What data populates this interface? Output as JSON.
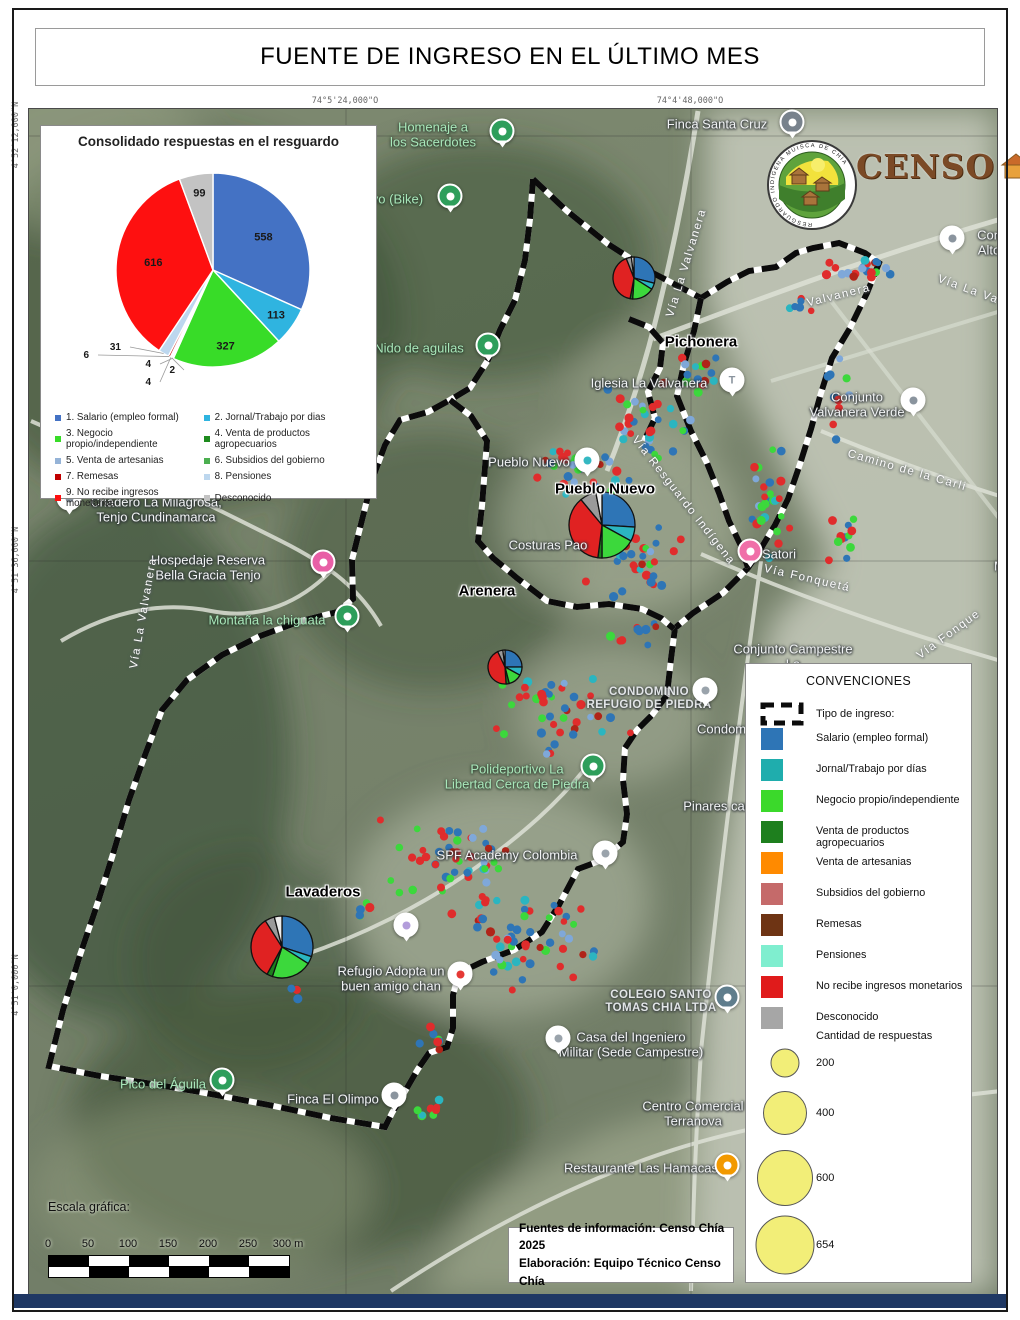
{
  "title": "FUENTE DE INGRESO EN EL ÚLTIMO MES",
  "coordinates": {
    "top": [
      "74°5'24,000\"O",
      "74°4'48,000\"O"
    ],
    "left": [
      "4°52'12,000\"N",
      "4°51'36,000\"N",
      "4°51'0,000\"N"
    ]
  },
  "chart_data": {
    "type": "pie",
    "title": "Consolidado respuestas en el resguardo",
    "labels": [
      "1. Salario (empleo formal)",
      "2. Jornal/Trabajo por dias",
      "3. Negocio propio/independiente",
      "4. Venta de productos agropecuarios",
      "5. Venta de artesanias",
      "6. Subsidios del gobierno",
      "7. Remesas",
      "8. Pensiones",
      "9. No recibe ingresos monetarios",
      "Desconocido"
    ],
    "values": [
      558,
      113,
      327,
      4,
      2,
      4,
      6,
      31,
      616,
      99
    ],
    "colors": [
      "#4472C4",
      "#2FB4E0",
      "#38DC28",
      "#1E8B1E",
      "#95B3D7",
      "#4CAF50",
      "#C00000",
      "#BDD7EE",
      "#FE1010",
      "#C3C3C3"
    ],
    "total": 1760,
    "legend_position": "bottom"
  },
  "legend_right": {
    "title": "CONVENCIONES",
    "boundary_label": "Tipo de ingreso:",
    "items": [
      {
        "label": "Salario (empleo formal)",
        "color": "#2E75B6"
      },
      {
        "label": "Jornal/Trabajo por días",
        "color": "#1FADAD"
      },
      {
        "label": "Negocio propio/independiente",
        "color": "#3BD92B"
      },
      {
        "label": "Venta de productos agropecuarios",
        "color": "#1E7F1E"
      },
      {
        "label": "Venta de artesanias",
        "color": "#FF8A00"
      },
      {
        "label": "Subsidios del gobierno",
        "color": "#C56A6A"
      },
      {
        "label": "Remesas",
        "color": "#6E3414"
      },
      {
        "label": "Pensiones",
        "color": "#7FEECF"
      },
      {
        "label": "No recibe ingresos monetarios",
        "color": "#E01B1B"
      },
      {
        "label": "Desconocido",
        "color": "#A6A6A6"
      }
    ],
    "sizes_title": "Cantidad de respuestas",
    "circle_color": "#F2EE78",
    "sizes": [
      {
        "value": "200",
        "d": 27
      },
      {
        "value": "400",
        "d": 42
      },
      {
        "value": "600",
        "d": 54
      },
      {
        "value": "654",
        "d": 57
      }
    ]
  },
  "scale": {
    "label": "Escala gráfica:",
    "ticks": [
      "0",
      "50",
      "100",
      "150",
      "200",
      "250",
      "300 m"
    ]
  },
  "sources": {
    "line1": "Fuentes de información: Censo Chía 2025",
    "line2": "Elaboración: Equipo Técnico Censo Chía"
  },
  "logos": {
    "censo_text": "CENSO",
    "ring_text": "RESGUARDO INDÍGENA MUISCA DE CHÍA"
  },
  "map": {
    "pie_colors": [
      "#2E75B6",
      "#2BB5C0",
      "#3CD83C",
      "#1E7F1E",
      "#E02222",
      "#9A9A9A",
      "#ECECEC"
    ],
    "pies": [
      {
        "name": "pichonera",
        "x": 633,
        "y": 277,
        "r": 21,
        "values": [
          29,
          5,
          17,
          2,
          41,
          4,
          2
        ]
      },
      {
        "name": "pueblo-nuevo",
        "x": 601,
        "y": 524,
        "r": 33,
        "values": [
          26,
          7,
          17,
          2,
          37,
          8,
          3
        ]
      },
      {
        "name": "arenera",
        "x": 504,
        "y": 666,
        "r": 17,
        "values": [
          25,
          8,
          13,
          3,
          44,
          5,
          2
        ]
      },
      {
        "name": "lavaderos",
        "x": 281,
        "y": 946,
        "r": 31,
        "values": [
          30,
          4,
          21,
          3,
          33,
          5,
          4
        ]
      }
    ],
    "dot_colors": [
      [
        "#E02C2C",
        40
      ],
      [
        "#2E75B6",
        22
      ],
      [
        "#3CD83C",
        15
      ],
      [
        "#2BB5C0",
        10
      ],
      [
        "#7FA8D9",
        6
      ],
      [
        "#B02418",
        7
      ]
    ],
    "dot_clusters": [
      {
        "x": 862,
        "y": 266,
        "rx": 38,
        "ry": 16,
        "n": 20,
        "seed": 1
      },
      {
        "x": 800,
        "y": 300,
        "rx": 18,
        "ry": 14,
        "n": 6,
        "seed": 2
      },
      {
        "x": 770,
        "y": 500,
        "rx": 26,
        "ry": 65,
        "n": 26,
        "seed": 3
      },
      {
        "x": 648,
        "y": 420,
        "rx": 48,
        "ry": 42,
        "n": 32,
        "seed": 4
      },
      {
        "x": 575,
        "y": 470,
        "rx": 58,
        "ry": 32,
        "n": 28,
        "seed": 5
      },
      {
        "x": 630,
        "y": 555,
        "rx": 58,
        "ry": 48,
        "n": 40,
        "seed": 6
      },
      {
        "x": 560,
        "y": 710,
        "rx": 75,
        "ry": 52,
        "n": 42,
        "seed": 7
      },
      {
        "x": 845,
        "y": 540,
        "rx": 25,
        "ry": 38,
        "n": 12,
        "seed": 8
      },
      {
        "x": 445,
        "y": 858,
        "rx": 72,
        "ry": 48,
        "n": 48,
        "seed": 9
      },
      {
        "x": 525,
        "y": 938,
        "rx": 82,
        "ry": 52,
        "n": 55,
        "seed": 10
      },
      {
        "x": 360,
        "y": 905,
        "rx": 18,
        "ry": 14,
        "n": 5,
        "seed": 11
      },
      {
        "x": 430,
        "y": 1038,
        "rx": 14,
        "ry": 16,
        "n": 7,
        "seed": 12
      },
      {
        "x": 428,
        "y": 1112,
        "rx": 14,
        "ry": 28,
        "n": 8,
        "seed": 13
      },
      {
        "x": 633,
        "y": 630,
        "rx": 30,
        "ry": 18,
        "n": 10,
        "seed": 14
      },
      {
        "x": 700,
        "y": 370,
        "rx": 25,
        "ry": 30,
        "n": 14,
        "seed": 15
      },
      {
        "x": 838,
        "y": 395,
        "rx": 18,
        "ry": 60,
        "n": 10,
        "seed": 16
      },
      {
        "x": 285,
        "y": 995,
        "rx": 14,
        "ry": 16,
        "n": 3,
        "seed": 17
      }
    ],
    "boundary_lines": [
      [
        [
          532,
          178
        ],
        [
          566,
          210
        ],
        [
          607,
          243
        ],
        [
          652,
          272
        ],
        [
          700,
          297
        ],
        [
          726,
          281
        ],
        [
          748,
          270
        ],
        [
          775,
          266
        ],
        [
          795,
          252
        ],
        [
          812,
          247
        ],
        [
          838,
          242
        ],
        [
          864,
          252
        ],
        [
          878,
          262
        ],
        [
          866,
          292
        ],
        [
          849,
          327
        ],
        [
          831,
          357
        ],
        [
          820,
          392
        ],
        [
          810,
          428
        ],
        [
          799,
          463
        ],
        [
          787,
          498
        ],
        [
          774,
          524
        ],
        [
          759,
          549
        ],
        [
          747,
          567
        ],
        [
          722,
          592
        ],
        [
          692,
          612
        ],
        [
          674,
          627
        ],
        [
          670,
          658
        ],
        [
          666,
          694
        ],
        [
          651,
          714
        ],
        [
          636,
          729
        ],
        [
          624,
          747
        ],
        [
          622,
          779
        ],
        [
          626,
          813
        ],
        [
          622,
          841
        ],
        [
          601,
          859
        ],
        [
          577,
          868
        ],
        [
          558,
          904
        ],
        [
          541,
          931
        ],
        [
          513,
          949
        ],
        [
          481,
          961
        ],
        [
          458,
          972
        ],
        [
          452,
          994
        ],
        [
          452,
          1027
        ],
        [
          446,
          1046
        ],
        [
          428,
          1052
        ],
        [
          417,
          1068
        ],
        [
          403,
          1092
        ],
        [
          391,
          1112
        ],
        [
          384,
          1126
        ],
        [
          330,
          1117
        ],
        [
          268,
          1104
        ],
        [
          199,
          1091
        ],
        [
          139,
          1081
        ],
        [
          99,
          1075
        ],
        [
          48,
          1065
        ],
        [
          62,
          1009
        ],
        [
          79,
          954
        ],
        [
          96,
          904
        ],
        [
          112,
          853
        ],
        [
          128,
          799
        ],
        [
          144,
          754
        ],
        [
          161,
          709
        ],
        [
          186,
          679
        ],
        [
          221,
          654
        ],
        [
          259,
          635
        ],
        [
          300,
          620
        ],
        [
          336,
          611
        ],
        [
          352,
          598
        ],
        [
          351,
          559
        ],
        [
          361,
          519
        ],
        [
          371,
          479
        ],
        [
          384,
          444
        ],
        [
          399,
          419
        ],
        [
          427,
          411
        ],
        [
          449,
          399
        ],
        [
          469,
          387
        ],
        [
          487,
          359
        ],
        [
          499,
          329
        ],
        [
          514,
          299
        ],
        [
          524,
          259
        ],
        [
          529,
          218
        ],
        [
          532,
          178
        ]
      ],
      [
        [
          449,
          399
        ],
        [
          470,
          415
        ],
        [
          486,
          440
        ],
        [
          481,
          505
        ],
        [
          477,
          540
        ],
        [
          492,
          557
        ],
        [
          516,
          577
        ],
        [
          546,
          600
        ],
        [
          576,
          606
        ],
        [
          608,
          603
        ],
        [
          641,
          608
        ],
        [
          660,
          617
        ],
        [
          673,
          628
        ]
      ],
      [
        [
          700,
          297
        ],
        [
          693,
          330
        ],
        [
          683,
          363
        ],
        [
          676,
          395
        ],
        [
          690,
          430
        ],
        [
          706,
          462
        ],
        [
          718,
          492
        ],
        [
          728,
          520
        ],
        [
          740,
          545
        ],
        [
          747,
          567
        ]
      ],
      [
        [
          628,
          318
        ],
        [
          648,
          326
        ],
        [
          662,
          342
        ],
        [
          659,
          367
        ],
        [
          647,
          391
        ],
        [
          654,
          417
        ],
        [
          643,
          440
        ]
      ]
    ],
    "labels": [
      {
        "t": [
          "Homenaje a",
          "los Sacerdotes"
        ],
        "x": 432,
        "y": 134,
        "c": "green"
      },
      {
        "t": [
          "ivo (Bike)"
        ],
        "x": 395,
        "y": 199,
        "c": "green"
      },
      {
        "t": [
          "Nido de aguilas"
        ],
        "x": 418,
        "y": 348,
        "c": "green"
      },
      {
        "t": [
          "Finca Santa Cruz"
        ],
        "x": 716,
        "y": 124,
        "c": "poi"
      },
      {
        "t": [
          "Con",
          "Alto"
        ],
        "x": 988,
        "y": 242,
        "c": "poi"
      },
      {
        "t": [
          "Vía La Valvanera"
        ],
        "x": 686,
        "y": 262,
        "c": "road",
        "r": -73
      },
      {
        "t": [
          "Valvanera"
        ],
        "x": 838,
        "y": 295,
        "c": "road",
        "r": -14
      },
      {
        "t": [
          "Vía La Va"
        ],
        "x": 967,
        "y": 289,
        "c": "road",
        "r": 20
      },
      {
        "t": [
          "Pichonera"
        ],
        "x": 700,
        "y": 342,
        "c": "place"
      },
      {
        "t": [
          "Iglesia La Valvanera"
        ],
        "x": 648,
        "y": 383,
        "c": "poi"
      },
      {
        "t": [
          "Conjunto",
          "Valvanera Verde"
        ],
        "x": 856,
        "y": 404,
        "c": "poi"
      },
      {
        "t": [
          "Camino de la Carli"
        ],
        "x": 906,
        "y": 470,
        "c": "road",
        "r": 16
      },
      {
        "t": [
          "Pueblo Nuevo"
        ],
        "x": 528,
        "y": 462,
        "c": "poi"
      },
      {
        "t": [
          "Pueblo Nuevo"
        ],
        "x": 604,
        "y": 489,
        "c": "place"
      },
      {
        "t": [
          "Vía Resguardo Indígena"
        ],
        "x": 682,
        "y": 500,
        "c": "road",
        "r": 52
      },
      {
        "t": [
          "Costuras Pao"
        ],
        "x": 547,
        "y": 545,
        "c": "poi"
      },
      {
        "t": [
          "Satori"
        ],
        "x": 778,
        "y": 554,
        "c": "poi"
      },
      {
        "t": [
          "Vía Fonquetá"
        ],
        "x": 806,
        "y": 578,
        "c": "road",
        "r": 13
      },
      {
        "t": [
          "Ma"
        ],
        "x": 1002,
        "y": 566,
        "c": "poi"
      },
      {
        "t": [
          "Arenera"
        ],
        "x": 486,
        "y": 591,
        "c": "place"
      },
      {
        "t": [
          "Vía Fonque"
        ],
        "x": 948,
        "y": 634,
        "c": "road",
        "r": -36
      },
      {
        "t": [
          "Criadero La Milagrosa,",
          "Tenjo  Cundinamarca"
        ],
        "x": 155,
        "y": 509,
        "c": "poi"
      },
      {
        "t": [
          "Hospedaje Reserva",
          "Bella Gracia Tenjo"
        ],
        "x": 207,
        "y": 567,
        "c": "poi"
      },
      {
        "t": [
          "Montaña la chiguata"
        ],
        "x": 266,
        "y": 620,
        "c": "green"
      },
      {
        "t": [
          "Vía La Valvanera"
        ],
        "x": 143,
        "y": 612,
        "c": "road",
        "r": -80
      },
      {
        "t": [
          "CONDOMINIO",
          "REFUGIO DE PIEDRA"
        ],
        "x": 648,
        "y": 698,
        "c": "caps"
      },
      {
        "t": [
          "Conjunto Campestre",
          "La"
        ],
        "x": 792,
        "y": 656,
        "c": "poi"
      },
      {
        "t": [
          "Condomi"
        ],
        "x": 722,
        "y": 729,
        "c": "poi"
      },
      {
        "t": [
          "Polideportivo La",
          "Libertad Cerca de Piedra"
        ],
        "x": 516,
        "y": 776,
        "c": "green"
      },
      {
        "t": [
          "Pinares camp"
        ],
        "x": 722,
        "y": 806,
        "c": "poi"
      },
      {
        "t": [
          "SPF Academy Colombia"
        ],
        "x": 506,
        "y": 855,
        "c": "poi"
      },
      {
        "t": [
          "Lavaderos"
        ],
        "x": 322,
        "y": 892,
        "c": "place"
      },
      {
        "t": [
          "Refugio Adopta un",
          "buen amigo chan"
        ],
        "x": 390,
        "y": 978,
        "c": "poi"
      },
      {
        "t": [
          "COLEGIO SANTO",
          "TOMAS CHIA LTDA"
        ],
        "x": 660,
        "y": 1001,
        "c": "caps"
      },
      {
        "t": [
          "Casa del Ingeniero",
          "Militar (Sede Campestre)"
        ],
        "x": 630,
        "y": 1044,
        "c": "poi"
      },
      {
        "t": [
          "Centro Comercial",
          "Terranova"
        ],
        "x": 692,
        "y": 1113,
        "c": "poi"
      },
      {
        "t": [
          "Restaurante Las Hamacas"
        ],
        "x": 640,
        "y": 1168,
        "c": "poi"
      },
      {
        "t": [
          "Pico del Águila"
        ],
        "x": 162,
        "y": 1084,
        "c": "green"
      },
      {
        "t": [
          "Finca El Olimpo"
        ],
        "x": 332,
        "y": 1099,
        "c": "poi"
      }
    ],
    "pins": [
      {
        "x": 501,
        "y": 133,
        "bg": "#2E9E5B"
      },
      {
        "x": 449,
        "y": 198,
        "bg": "#2E9E5B"
      },
      {
        "x": 487,
        "y": 347,
        "bg": "#2E9E5B"
      },
      {
        "x": 791,
        "y": 124,
        "bg": "#78828C"
      },
      {
        "x": 951,
        "y": 240,
        "bg": "#ffffff",
        "dot": "#8a949e"
      },
      {
        "x": 731,
        "y": 382,
        "bg": "#ffffff",
        "letter": "T"
      },
      {
        "x": 912,
        "y": 402,
        "bg": "#ffffff",
        "dot": "#8a949e"
      },
      {
        "x": 586,
        "y": 462,
        "bg": "#ffffff",
        "dot": "#35b8c2"
      },
      {
        "x": 749,
        "y": 553,
        "bg": "#F06FA8"
      },
      {
        "x": 68,
        "y": 500,
        "bg": "#ffffff",
        "dot": "#8a949e"
      },
      {
        "x": 322,
        "y": 564,
        "bg": "#E85FA6"
      },
      {
        "x": 346,
        "y": 618,
        "bg": "#2E9E5B"
      },
      {
        "x": 704,
        "y": 692,
        "bg": "#ffffff",
        "dot": "#9aa3ab"
      },
      {
        "x": 592,
        "y": 768,
        "bg": "#2E9E5B"
      },
      {
        "x": 604,
        "y": 855,
        "bg": "#ffffff",
        "dot": "#9aa3ab"
      },
      {
        "x": 405,
        "y": 927,
        "bg": "#ffffff",
        "dot": "#b39ddb"
      },
      {
        "x": 459,
        "y": 976,
        "bg": "#ffffff",
        "dot": "#e53935"
      },
      {
        "x": 726,
        "y": 999,
        "bg": "#5F7D8C"
      },
      {
        "x": 557,
        "y": 1040,
        "bg": "#ffffff",
        "dot": "#9aa3ab"
      },
      {
        "x": 726,
        "y": 1167,
        "bg": "#F29900"
      },
      {
        "x": 221,
        "y": 1082,
        "bg": "#2E9E5B"
      },
      {
        "x": 393,
        "y": 1097,
        "bg": "#ffffff",
        "dot": "#8a949e"
      }
    ]
  }
}
